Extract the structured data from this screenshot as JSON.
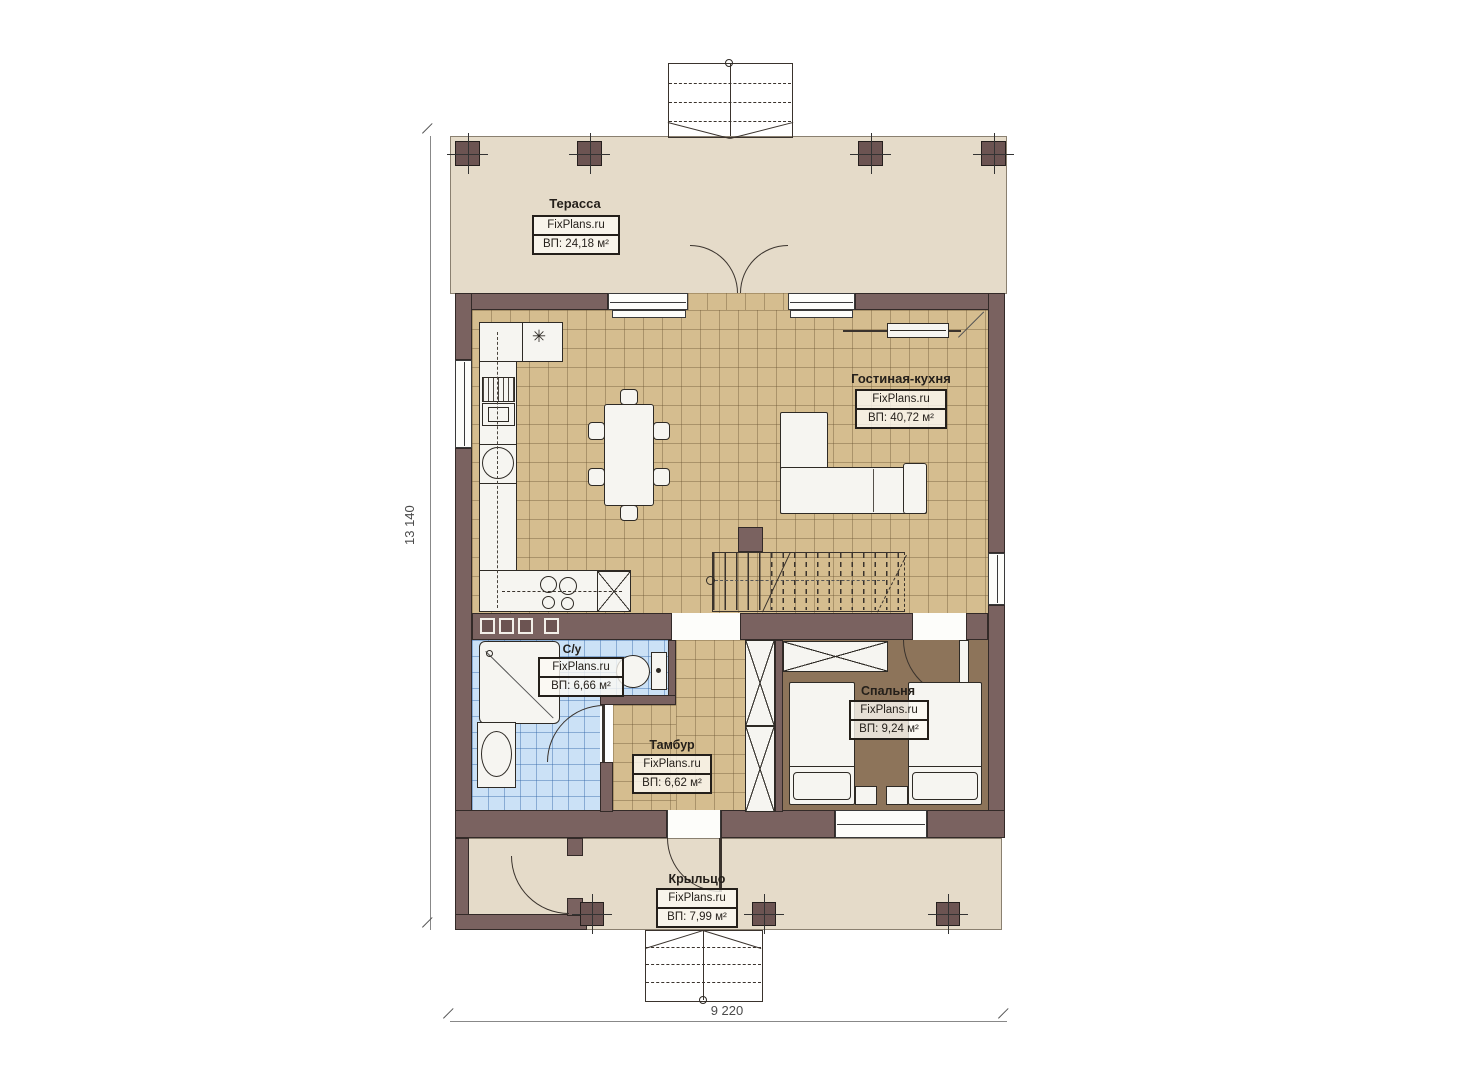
{
  "rooms": {
    "terrace": {
      "name": "Терасса",
      "brand": "FixPlans.ru",
      "area": "ВП: 24,18 м²"
    },
    "living": {
      "name": "Гостиная-кухня",
      "brand": "FixPlans.ru",
      "area": "ВП: 40,72 м²"
    },
    "bathroom": {
      "name": "С/у",
      "brand": "FixPlans.ru",
      "area": "ВП: 6,66 м²"
    },
    "bedroom": {
      "name": "Спальня",
      "brand": "FixPlans.ru",
      "area": "ВП: 9,24 м²"
    },
    "vestibule": {
      "name": "Тамбур",
      "brand": "FixPlans.ru",
      "area": "ВП: 6,62 м²"
    },
    "porch": {
      "name": "Крыльцо",
      "brand": "FixPlans.ru",
      "area": "ВП: 7,99 м²"
    }
  },
  "dimensions": {
    "overall_height": "13 140",
    "overall_width": "9 220"
  },
  "colors": {
    "wall": "#7a6260",
    "floor_tile": "#d5bd8f",
    "bath_tile": "#cbe1f6",
    "bedroom_floor": "#8d745a",
    "outdoor": "#e5dbc9"
  }
}
